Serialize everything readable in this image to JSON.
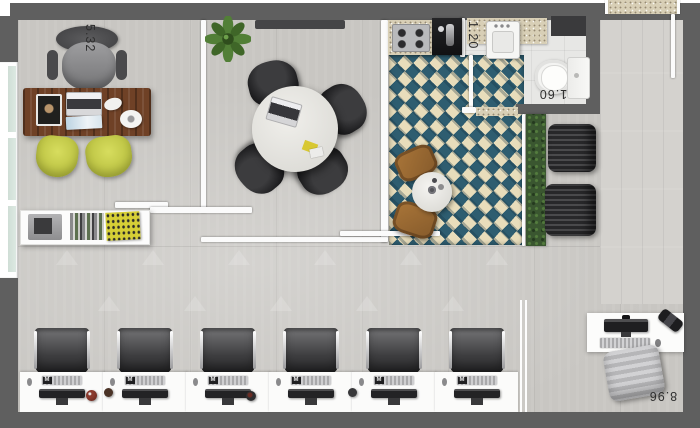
{
  "floorplan": {
    "dimensions": {
      "left_width": "5.32",
      "bath_width": "1.20",
      "bath_depth": "1.60",
      "bottom_length": "8.96"
    },
    "workstations": {
      "count": 6,
      "keyboard_badge": "M"
    },
    "meeting_chairs": 4,
    "lounge_chairs": 2,
    "colors": {
      "wall_gray": "#5f5f5f",
      "floor_gray": "#c8c6c2",
      "corridor_floor": "#d4d2ce",
      "tile_teal": "#2e5d70",
      "tile_cream": "#e8ddbb",
      "desk_wood_brown": "#6f4126",
      "guest_chair_yellow": "#c9cf4b",
      "hedge_green": "#3a5630",
      "wood_chair_brown": "#9a6a36"
    }
  }
}
